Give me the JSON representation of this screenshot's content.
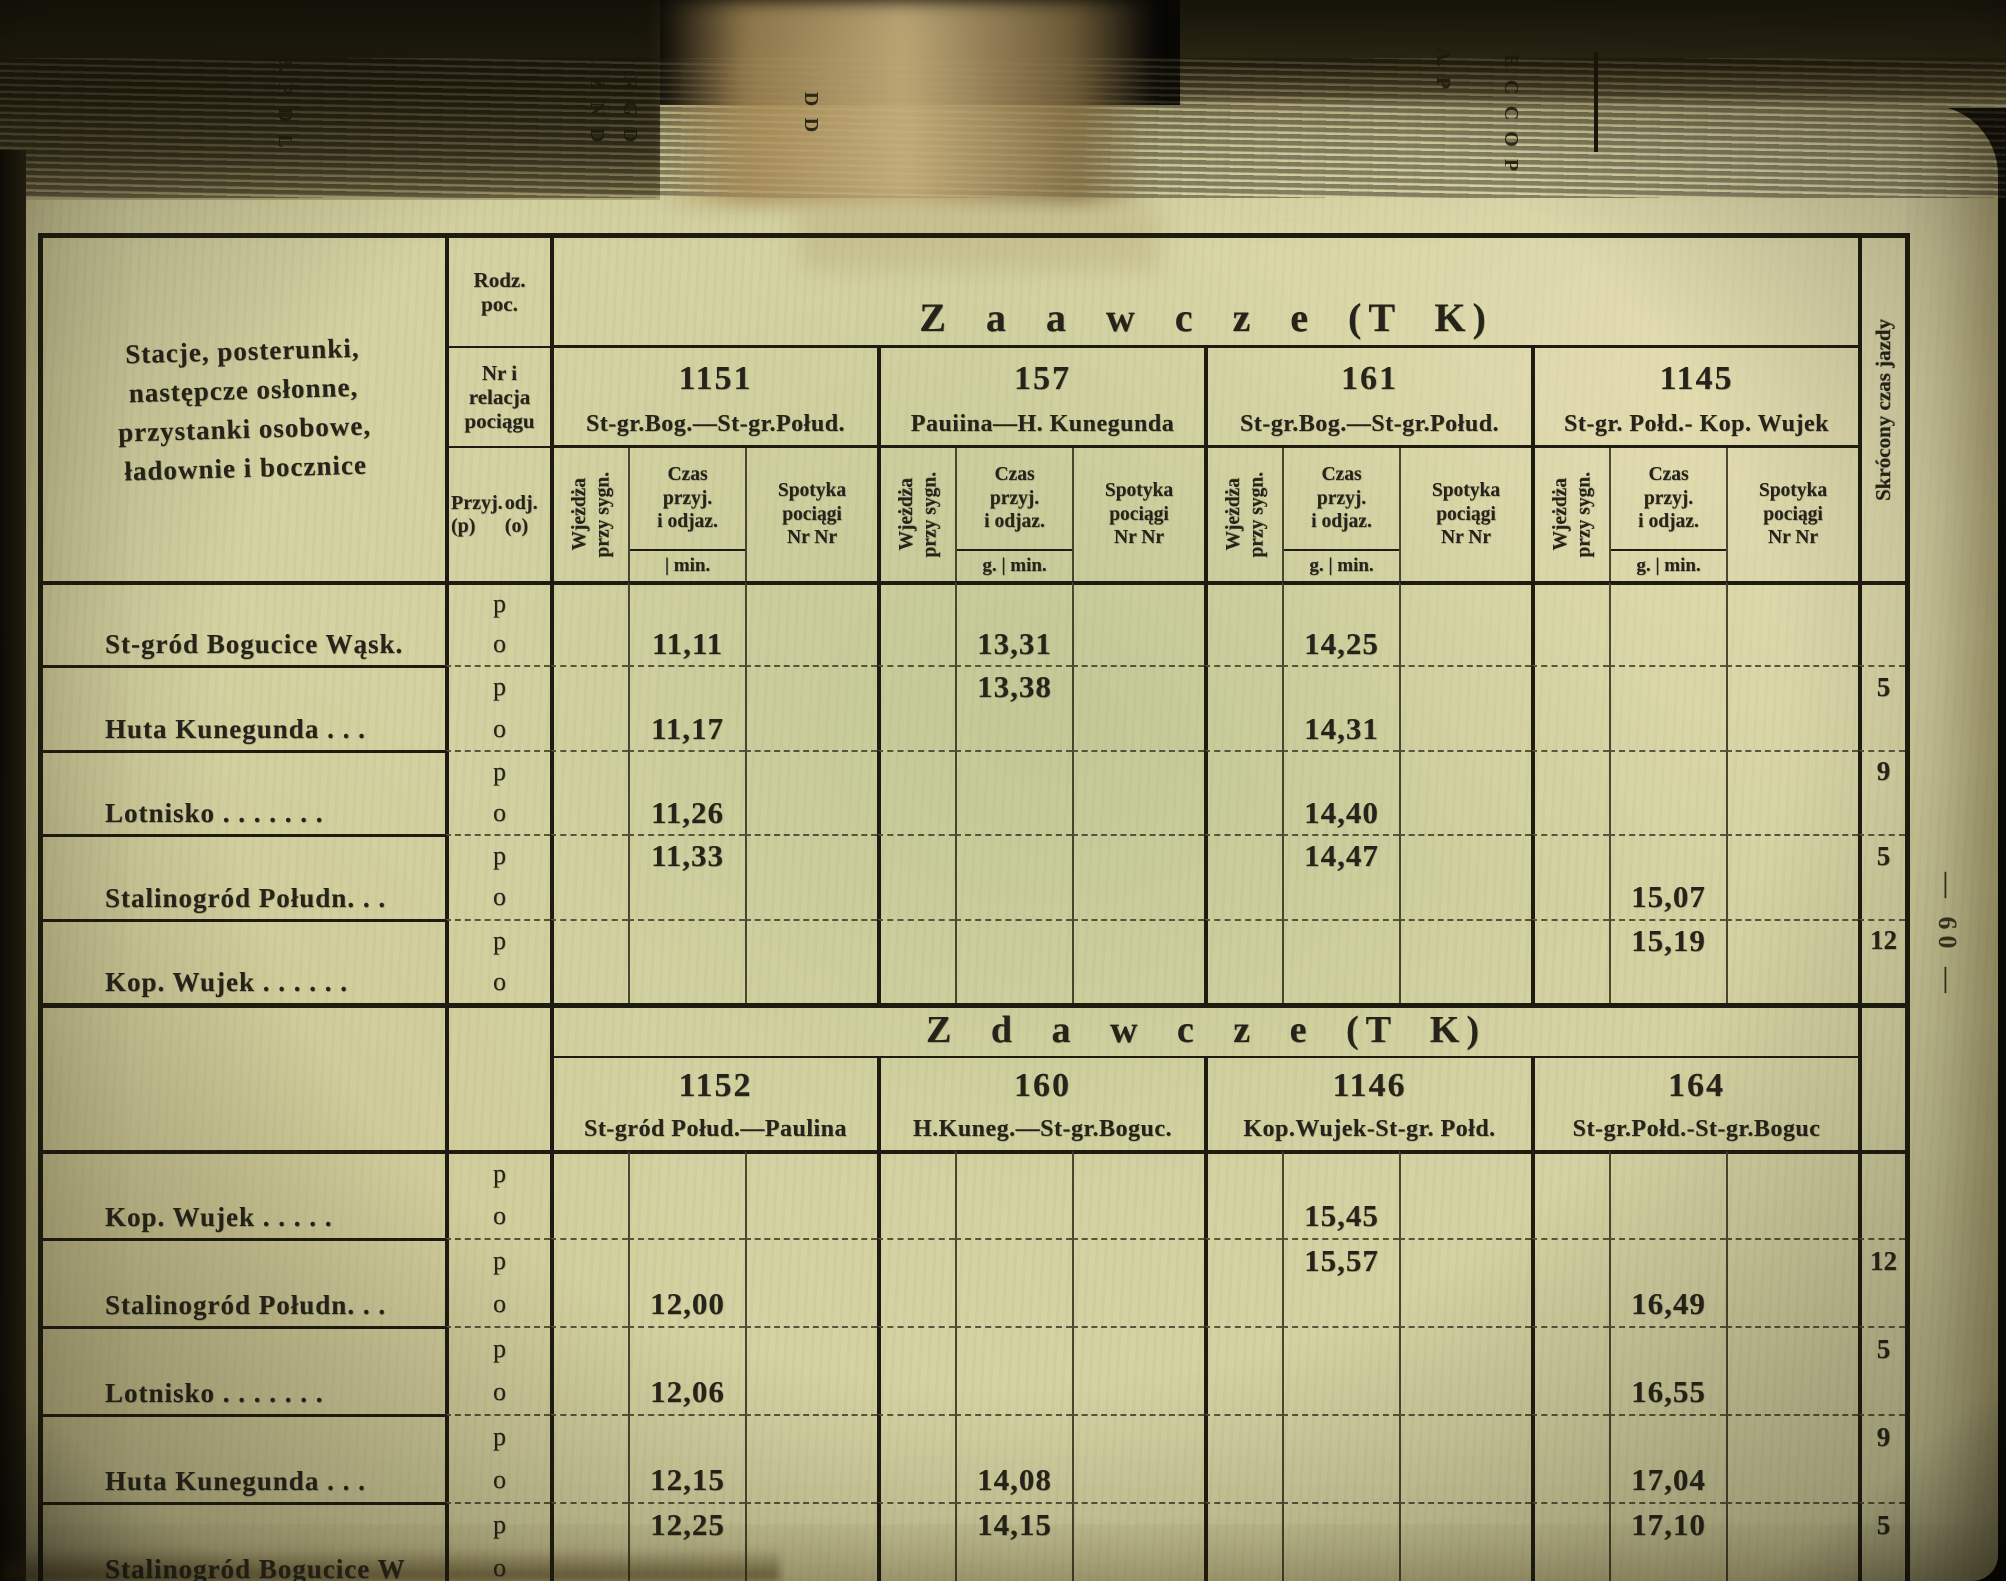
{
  "photo": {
    "page_number_vertical": "— 60 —",
    "spine_fragments": [
      {
        "x": 272,
        "y": 52,
        "letters": [
          "B.",
          "P",
          "D",
          "L"
        ]
      },
      {
        "x": 584,
        "y": 46,
        "letters": [
          "D.",
          "Z",
          "N",
          "D"
        ]
      },
      {
        "x": 617,
        "y": 46,
        "letters": [
          "P",
          "R",
          "G",
          "D"
        ]
      },
      {
        "x": 798,
        "y": 88,
        "letters": [
          "D",
          "D"
        ]
      },
      {
        "x": 1430,
        "y": 46,
        "letters": [
          "A.",
          "P"
        ]
      },
      {
        "x": 1498,
        "y": 50,
        "letters": [
          "E",
          "C",
          "C",
          "O",
          "P"
        ]
      }
    ]
  },
  "table": {
    "station_column_header_lines": [
      "Stacje, posterunki,",
      "następcze osłonne,",
      "przystanki osobowe,",
      "ładownie i bocznice"
    ],
    "type_column": {
      "kind": "Rodz.\npoc.",
      "number_relation": "Nr i\nrelacja\npociągu",
      "arrival": "Przyj.(p)",
      "departure": "odj. (o)"
    },
    "sub_headers": {
      "entry": "Wjeżdża\nprzy sygn.",
      "time": "Czas\nprzyj.\ni odjaz.",
      "meet": "Spotyka\npociągi\nNr Nr"
    },
    "shortened_time_header": "Skrócony czas jazdy"
  },
  "row_letters": {
    "p": "p",
    "o": "o"
  },
  "sections": [
    {
      "title": "Z a a w c z e   (T K)",
      "trains": [
        {
          "number": "1151",
          "relation": "St-gr.Bog.—St-gr.Połud.",
          "min_label": "| min."
        },
        {
          "number": "157",
          "relation": "Pauiina—H. Kunegunda",
          "min_label": "g. | min."
        },
        {
          "number": "161",
          "relation": "St-gr.Bog.—St-gr.Połud.",
          "min_label": "g. | min."
        },
        {
          "number": "1145",
          "relation": "St-gr. Połd.- Kop. Wujek",
          "min_label": "g. | min."
        }
      ],
      "blocks": [
        {
          "station": "St-gród Bogucice Wąsk.",
          "p": [
            "",
            "",
            "",
            ""
          ],
          "o": [
            "11,11",
            "13,31",
            "14,25",
            ""
          ],
          "margin": ""
        },
        {
          "station": "Huta Kunegunda  .  .  .",
          "p": [
            "",
            "13,38",
            "",
            ""
          ],
          "o": [
            "11,17",
            "",
            "14,31",
            ""
          ],
          "margin": "5"
        },
        {
          "station": "Lotnisko  .  .  .  .  .  .  .",
          "p": [
            "",
            "",
            "",
            ""
          ],
          "o": [
            "11,26",
            "",
            "14,40",
            ""
          ],
          "margin": "9"
        },
        {
          "station": "Stalinogród Połudn. .  .",
          "p": [
            "11,33",
            "",
            "14,47",
            ""
          ],
          "o": [
            "",
            "",
            "",
            "15,07"
          ],
          "margin": "5"
        },
        {
          "station": "Kop. Wujek .  .  .  .  .  .",
          "p": [
            "",
            "",
            "",
            "15,19"
          ],
          "o": [
            "",
            "",
            "",
            ""
          ],
          "margin": "12"
        }
      ]
    },
    {
      "title": "Z d a w c z e   (T K)",
      "trains": [
        {
          "number": "1152",
          "relation": "St-gród Połud.—Paulina",
          "min_label": ""
        },
        {
          "number": "160",
          "relation": "H.Kuneg.—St-gr.Boguc.",
          "min_label": ""
        },
        {
          "number": "1146",
          "relation": "Kop.Wujek-St-gr. Połd.",
          "min_label": ""
        },
        {
          "number": "164",
          "relation": "St-gr.Połd.-St-gr.Boguc",
          "min_label": ""
        }
      ],
      "blocks": [
        {
          "station": "Kop. Wujek  .  .  .  .  .",
          "p": [
            "",
            "",
            "",
            ""
          ],
          "o": [
            "",
            "",
            "15,45",
            ""
          ],
          "margin": ""
        },
        {
          "station": "Stalinogród Połudn. .  .",
          "p": [
            "",
            "",
            "15,57",
            ""
          ],
          "o": [
            "12,00",
            "",
            "",
            "16,49"
          ],
          "margin": "12"
        },
        {
          "station": "Lotnisko  .  .  .  .  .  .  .",
          "p": [
            "",
            "",
            "",
            ""
          ],
          "o": [
            "12,06",
            "",
            "",
            "16,55"
          ],
          "margin": "5"
        },
        {
          "station": "Huta Kunegunda  .  .  .",
          "p": [
            "",
            "",
            "",
            ""
          ],
          "o": [
            "12,15",
            "14,08",
            "",
            "17,04"
          ],
          "margin": "9"
        },
        {
          "station": "Stalinogród Bogucice W",
          "p": [
            "12,25",
            "14,15",
            "",
            "17,10"
          ],
          "o": [
            "",
            "",
            "",
            ""
          ],
          "margin": "5"
        }
      ]
    }
  ]
}
